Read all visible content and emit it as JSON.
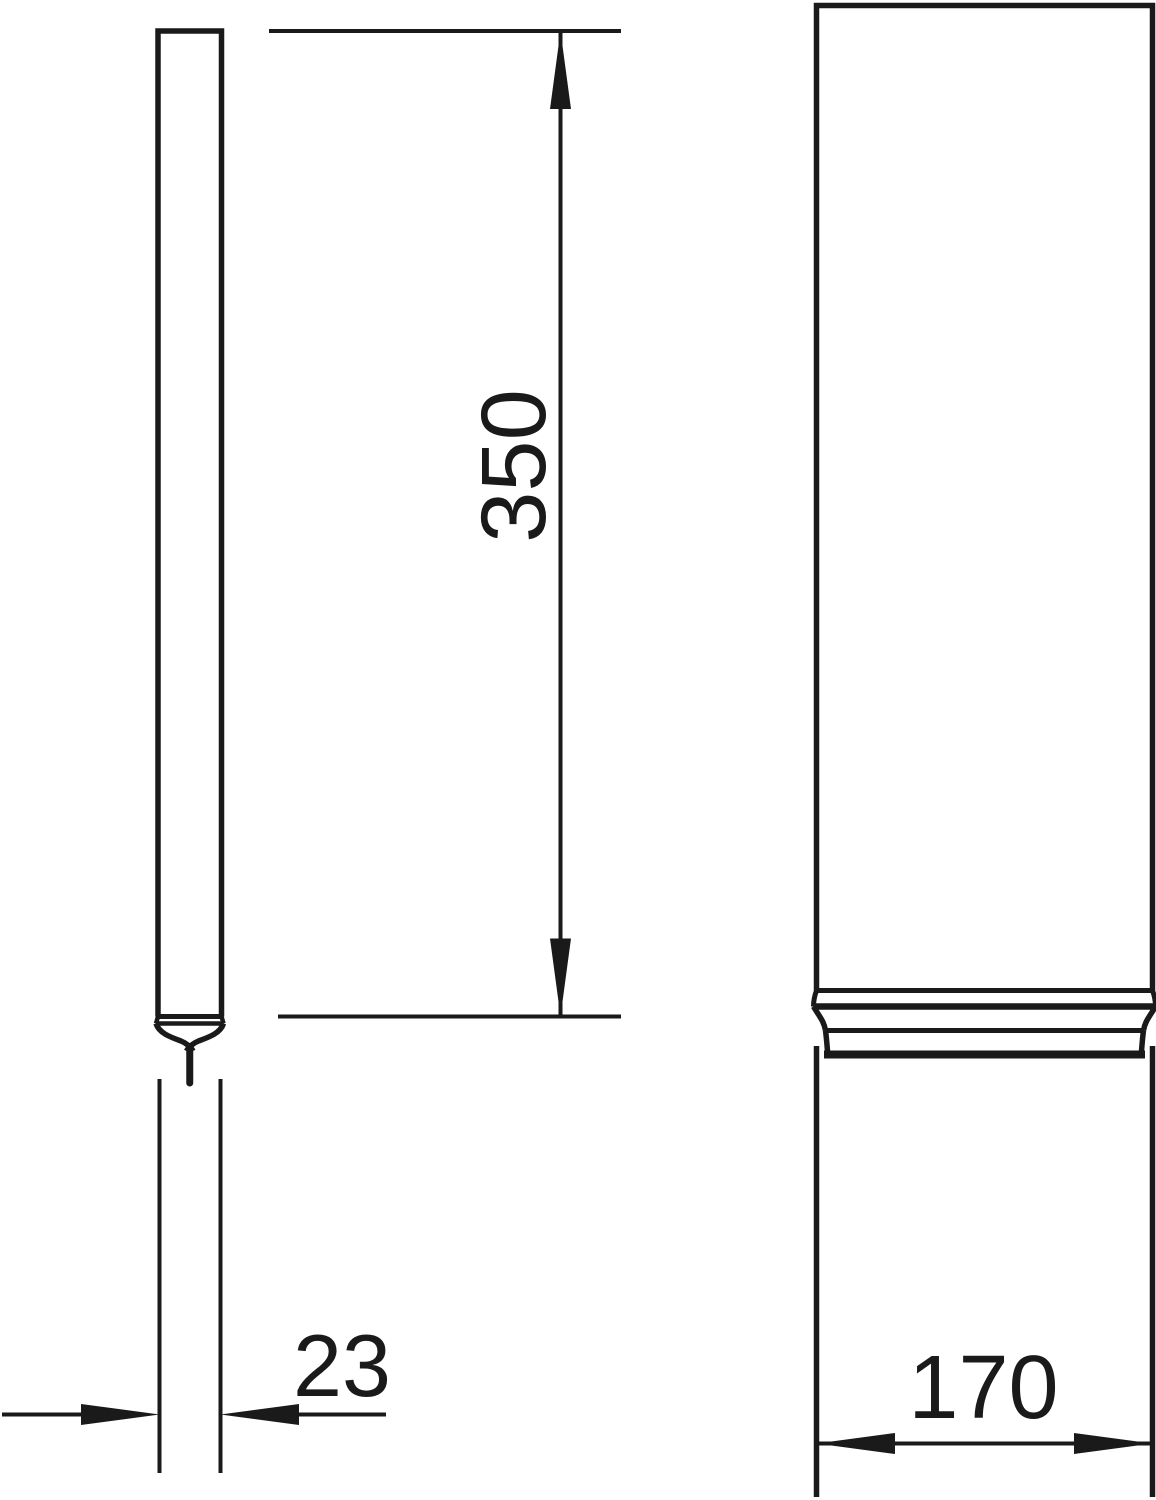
{
  "drawing": {
    "background_color": "#ffffff",
    "line_color": "#1a1a1a",
    "dimensions": {
      "side_height": {
        "label": "350"
      },
      "side_width": {
        "label": "23"
      },
      "front_width": {
        "label": "170"
      }
    }
  }
}
